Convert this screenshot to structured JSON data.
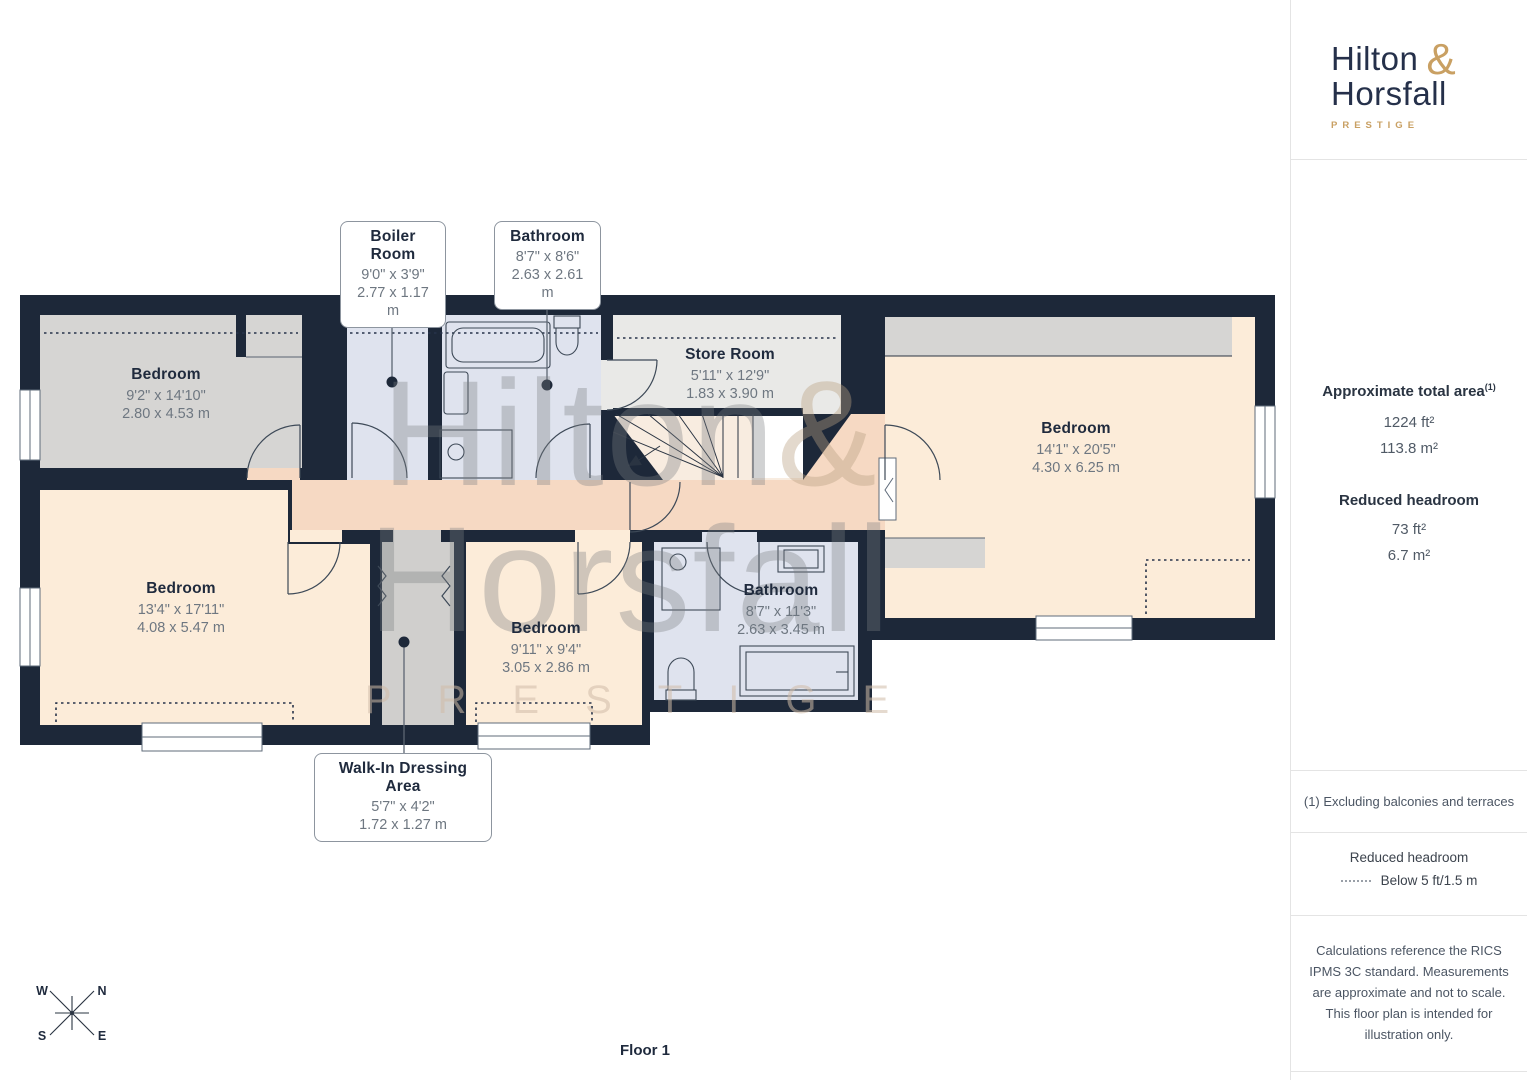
{
  "sidebar": {
    "logo": {
      "name_line1": "Hilton",
      "amp": "&",
      "name_line2": "Horsfall",
      "tagline": "PRESTIGE"
    },
    "area": {
      "title": "Approximate total area",
      "footnote_marker": "(1)",
      "imperial": "1224 ft²",
      "metric": "113.8 m²",
      "reduced_title": "Reduced headroom",
      "reduced_imperial": "73 ft²",
      "reduced_metric": "6.7 m²"
    },
    "footnote": "(1) Excluding balconies and terraces",
    "legend": {
      "title": "Reduced headroom",
      "entry": "Below 5 ft/1.5 m"
    },
    "disclaimer": "Calculations reference the RICS IPMS 3C standard. Measurements are approximate and not to scale. This floor plan is intended for illustration only."
  },
  "plan": {
    "floor_label": "Floor 1",
    "compass": {
      "n": "N",
      "e": "E",
      "s": "S",
      "w": "W"
    },
    "watermark": {
      "name_line1": "Hilton",
      "amp": "&",
      "name_line2": "Horsfall",
      "tagline": "PRESTIGE"
    },
    "rooms": {
      "bedroom_top_left": {
        "name": "Bedroom",
        "imperial": "9'2\" x 14'10\"",
        "metric": "2.80 x 4.53 m"
      },
      "bedroom_bottom_left": {
        "name": "Bedroom",
        "imperial": "13'4\" x 17'11\"",
        "metric": "4.08 x 5.47 m"
      },
      "bedroom_middle": {
        "name": "Bedroom",
        "imperial": "9'11\" x 9'4\"",
        "metric": "3.05 x 2.86 m"
      },
      "bedroom_right": {
        "name": "Bedroom",
        "imperial": "14'1\" x 20'5\"",
        "metric": "4.30 x 6.25 m"
      },
      "store_room": {
        "name": "Store Room",
        "imperial": "5'11\" x 12'9\"",
        "metric": "1.83 x 3.90 m"
      },
      "bathroom_bottom": {
        "name": "Bathroom",
        "imperial": "8'7\" x 11'3\"",
        "metric": "2.63 x 3.45 m"
      }
    },
    "callouts": {
      "boiler_room": {
        "name": "Boiler Room",
        "imperial": "9'0\" x 3'9\"",
        "metric": "2.77 x 1.17 m"
      },
      "bathroom_top": {
        "name": "Bathroom",
        "imperial": "8'7\" x 8'6\"",
        "metric": "2.63 x 2.61 m"
      },
      "walk_in": {
        "name": "Walk-In Dressing Area",
        "imperial": "5'7\" x 4'2\"",
        "metric": "1.72 x 1.27 m"
      }
    }
  },
  "colors": {
    "wall": "#1d2839",
    "room_grey": "#d6d5d3",
    "room_cream": "#fcecd9",
    "room_blue": "#dfe3ee",
    "hallway_peach": "#f6d9c3",
    "store_grey": "#e9e9e7",
    "brand_navy": "#25304a",
    "brand_gold": "#c9a063",
    "dim_text": "#6e7781"
  }
}
